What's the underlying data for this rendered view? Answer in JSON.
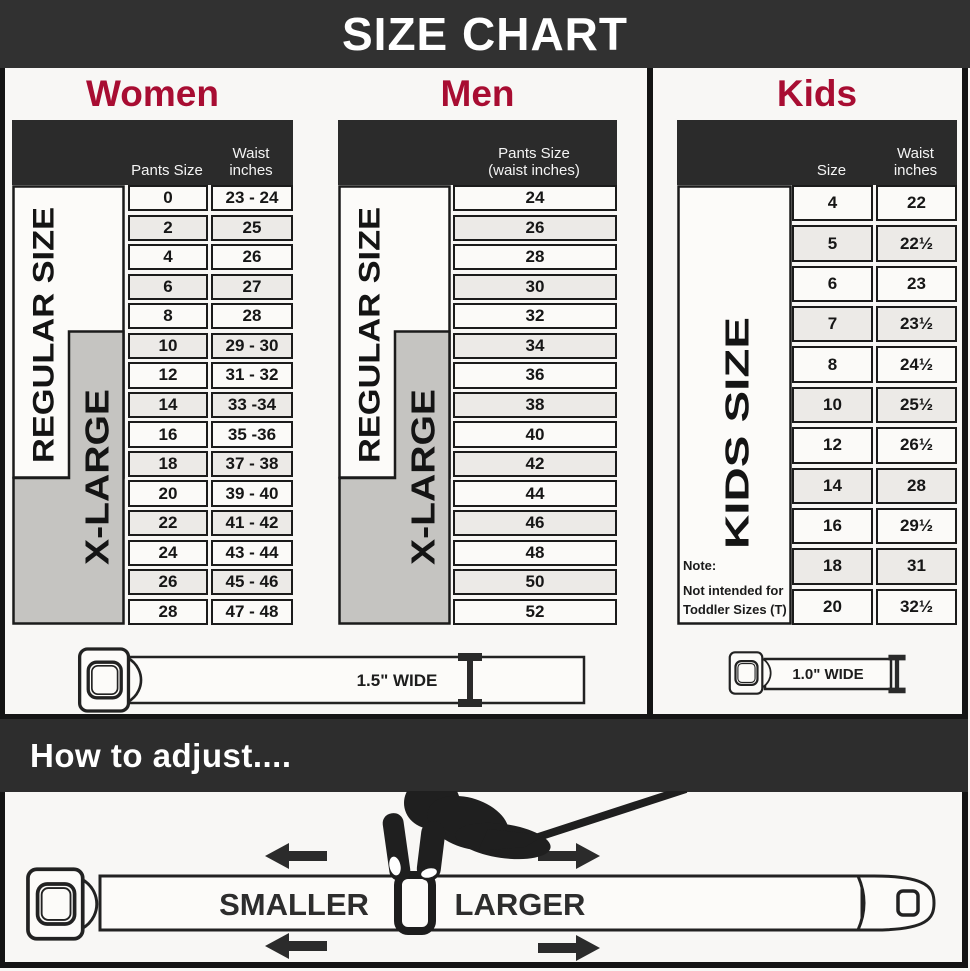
{
  "title": "SIZE CHART",
  "colors": {
    "banner": "#313131",
    "accent": "#a80d32",
    "group_grey": "#c5c4c1",
    "ink": "#1b1b1b"
  },
  "women": {
    "heading": "Women",
    "col_pants": "Pants Size",
    "waist_header": [
      "Waist",
      "inches"
    ],
    "regular_label": "REGULAR SIZE",
    "xlarge_label": "X-LARGE",
    "rows": [
      {
        "pants": "0",
        "waist": "23 - 24"
      },
      {
        "pants": "2",
        "waist": "25"
      },
      {
        "pants": "4",
        "waist": "26"
      },
      {
        "pants": "6",
        "waist": "27"
      },
      {
        "pants": "8",
        "waist": "28"
      },
      {
        "pants": "10",
        "waist": "29 - 30"
      },
      {
        "pants": "12",
        "waist": "31 - 32"
      },
      {
        "pants": "14",
        "waist": "33 -34"
      },
      {
        "pants": "16",
        "waist": "35 -36"
      },
      {
        "pants": "18",
        "waist": "37 - 38"
      },
      {
        "pants": "20",
        "waist": "39 - 40"
      },
      {
        "pants": "22",
        "waist": "41 - 42"
      },
      {
        "pants": "24",
        "waist": "43 - 44"
      },
      {
        "pants": "26",
        "waist": "45 - 46"
      },
      {
        "pants": "28",
        "waist": "47 - 48"
      }
    ]
  },
  "men": {
    "heading": "Men",
    "header": [
      "Pants Size",
      "(waist inches)"
    ],
    "regular_label": "REGULAR SIZE",
    "xlarge_label": "X-LARGE",
    "rows": [
      "24",
      "26",
      "28",
      "30",
      "32",
      "34",
      "36",
      "38",
      "40",
      "42",
      "44",
      "46",
      "48",
      "50",
      "52"
    ]
  },
  "kids": {
    "heading": "Kids",
    "col_size": "Size",
    "waist_header": [
      "Waist",
      "inches"
    ],
    "group_label": "KIDS SIZE",
    "note": [
      "Note:",
      "Not intended for",
      "Toddler Sizes (T)"
    ],
    "rows": [
      {
        "size": "4",
        "waist": "22"
      },
      {
        "size": "5",
        "waist": "22½"
      },
      {
        "size": "6",
        "waist": "23"
      },
      {
        "size": "7",
        "waist": "23½"
      },
      {
        "size": "8",
        "waist": "24½"
      },
      {
        "size": "10",
        "waist": "25½"
      },
      {
        "size": "12",
        "waist": "26½"
      },
      {
        "size": "14",
        "waist": "28"
      },
      {
        "size": "16",
        "waist": "29½"
      },
      {
        "size": "18",
        "waist": "31"
      },
      {
        "size": "20",
        "waist": "32½"
      }
    ]
  },
  "belts": {
    "adult_width_label": "1.5\" WIDE",
    "kids_width_label": "1.0\" WIDE"
  },
  "adjust": {
    "heading": "How to adjust....",
    "smaller": "SMALLER",
    "larger": "LARGER"
  }
}
